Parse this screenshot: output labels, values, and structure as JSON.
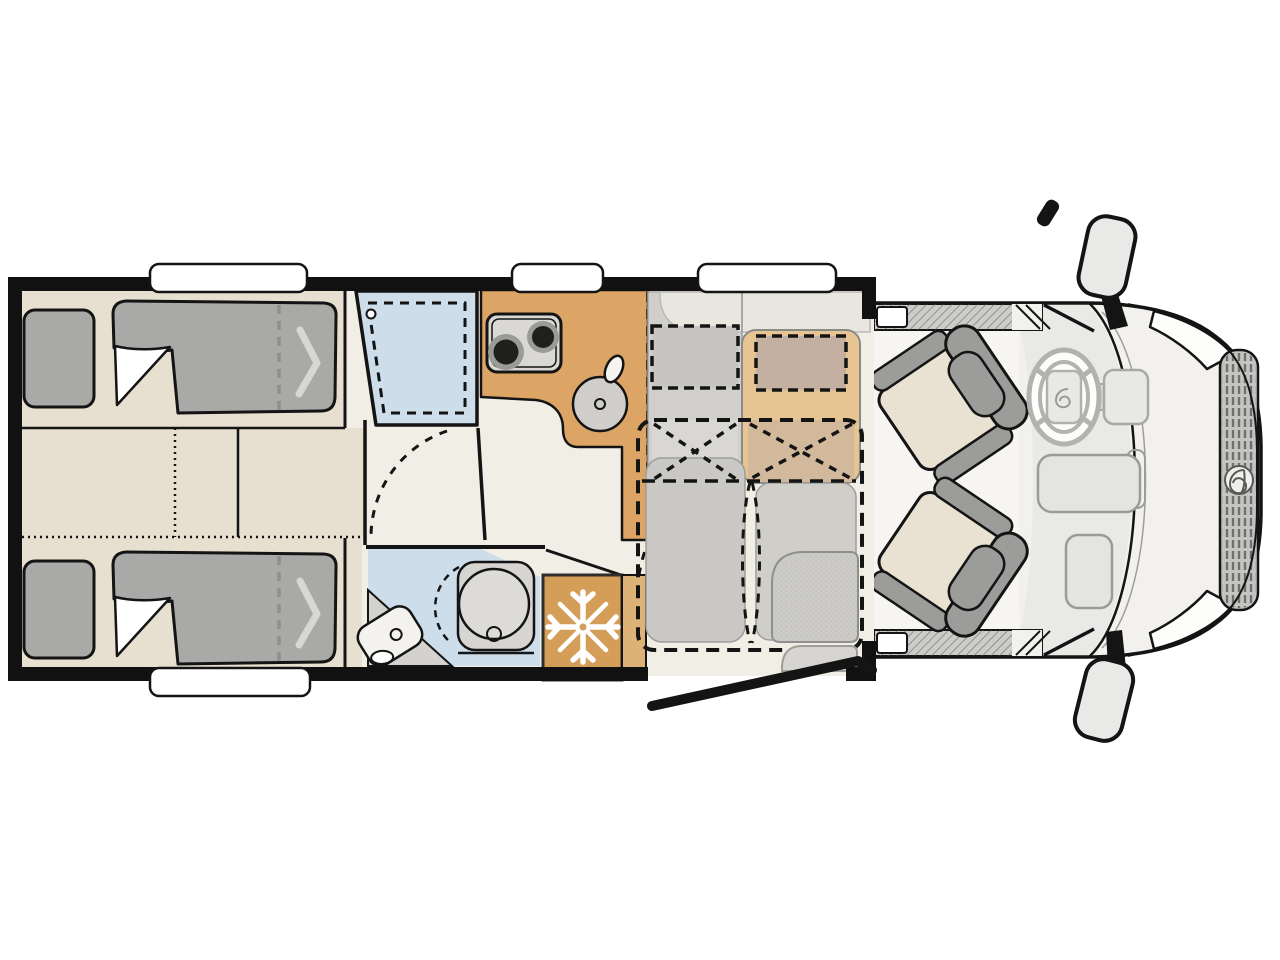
{
  "diagram": {
    "kind": "motorhome-floorplan-top-view",
    "orientation": "cab-on-right",
    "zones": [
      {
        "name": "rear-twin-beds",
        "features": [
          "pillow",
          "duvet",
          "fold-out-extension-dashes",
          "center-step-cabinets"
        ]
      },
      {
        "name": "shower-cubicle",
        "features": [
          "shower-tray-dashed",
          "drain"
        ]
      },
      {
        "name": "washroom",
        "features": [
          "swivel-toilet",
          "corner-washbasin",
          "door-swing-arc"
        ]
      },
      {
        "name": "kitchen",
        "features": [
          "two-burner-hob",
          "round-sink",
          "faucet",
          "refrigerator"
        ]
      },
      {
        "name": "dinette",
        "features": [
          "side-bench",
          "travel-seats-belt-cross-dashes",
          "drop-down-bed-dashed-outline",
          "table",
          "entry-step"
        ]
      },
      {
        "name": "cab",
        "features": [
          "driver-swivel-seat",
          "passenger-swivel-seat",
          "steering-wheel",
          "dashboard-console",
          "door-sills",
          "exterior-mirrors",
          "headlights",
          "grille-with-logo"
        ]
      }
    ],
    "window_count": 4,
    "bed_count": 2,
    "cab_seat_count": 2
  },
  "colors": {
    "background": "#ffffff",
    "outline": "#141414",
    "wall": "#111111",
    "floor": "#f1eee6",
    "bed_platform": "#e7e0d0",
    "pillow": "#a9a9a7",
    "blanket": "#a9a9a7",
    "blanket_fold": "#ffffff",
    "blanket_chevron": "#d8d7d3",
    "bed_divider_dash": "#8f8f8d",
    "shower": "#cdddea",
    "bath_floor": "#cdddea",
    "vanity": "#d3d2cf",
    "basin": "#f4f2ee",
    "toilet_body": "#d6d5d2",
    "toilet_bowl": "#dcdbd8",
    "kitchen": "#dca565",
    "kitchen_side": "#ddb277",
    "fridge": "#d59e58",
    "snowflake": "#ffffff",
    "stove": "#d9d8d5",
    "burner_dark": "#1f1f1e",
    "burner_ring": "#9a9a98",
    "sink": "#cfcecb",
    "cabinet_gray": "#d0cfcc",
    "shelf_cream": "#e9e6e0",
    "bench": "#e6c593",
    "bench_backrest": "#c4b0a0",
    "cabinet_backrest": "#c6c5c2",
    "bench_seat_patch": "#d2b99c",
    "cabinet_seat_patch": "#d8d7d3",
    "mattress_left": "#c9c8c5",
    "mattress_right": "#cfcec9",
    "table": "#cccbc8",
    "step": "#d6d5d2",
    "cab_body": "#f2f1ee",
    "cab_floor": "#f7f5f1",
    "dashboard": "#e9e9e7",
    "sill": "#ccccc9",
    "seat_cushion": "#e9e2d2",
    "seat_trim": "#9c9c9a",
    "console": "#e4e4e2",
    "wheel_gray": "#b2b2b0",
    "hub": "#e8e8e6",
    "grille": "#c4c4c2",
    "mirror": "#e9e9e7",
    "window": "#ffffff"
  }
}
